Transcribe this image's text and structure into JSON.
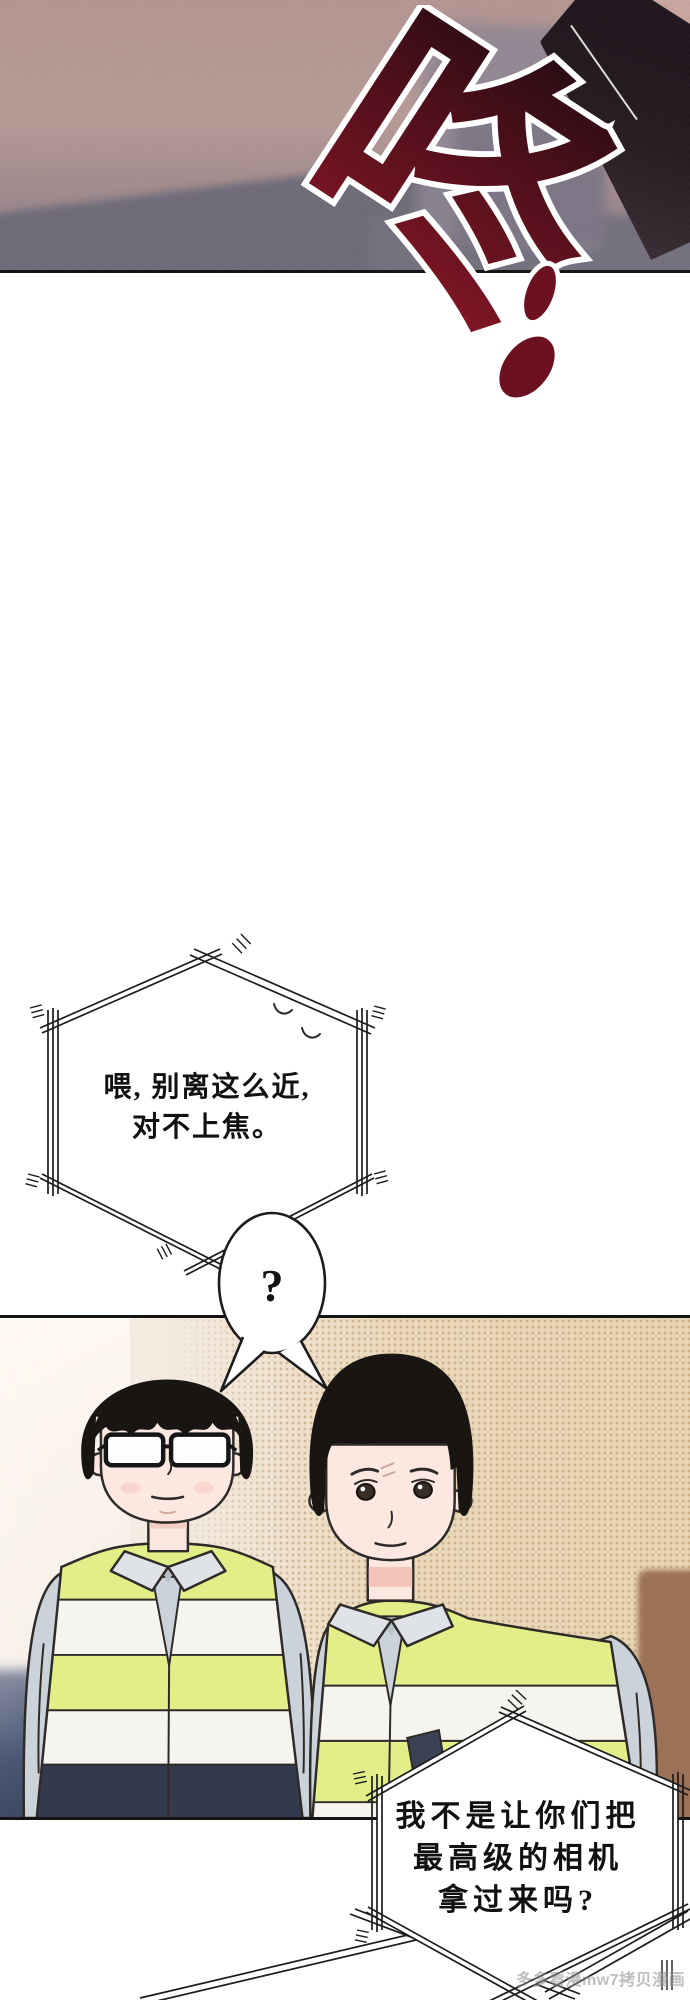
{
  "page": {
    "width": 690,
    "height": 2000
  },
  "sfx": {
    "text": "咚"
  },
  "bubbles": {
    "b1_line1": "喂, 别离这么近,",
    "b1_line2": "对不上焦。",
    "question": "?",
    "b2_line1": "我不是让你们把",
    "b2_line2": "最高级的相机",
    "b2_line3": "拿过来吗?"
  },
  "watermark": {
    "text": "多多看漫mw7拷贝漫画"
  },
  "colors": {
    "sfx_dark": "#140a10",
    "sfx_mid": "#4b0f1a",
    "sfx_red": "#8a1726",
    "outline": "#2d2a28",
    "panel1_wall": "#b39591",
    "panel1_shadow": "#6f6b79",
    "panel1_dark": "#261c22",
    "panel2_left": "#f8f1ec",
    "panel2_beige": "#e9d8ba",
    "panel2_brown": "#9b7158",
    "vest_yellow": "#e2ef89",
    "vest_white": "#f6f4ee",
    "vest_navy": "#333a4e",
    "shirt_gray": "#ccd2d9",
    "collar_gray": "#dfe3e8",
    "skin": "#fce8e1",
    "hair_black": "#181512",
    "bubble_line": "#1c1c1c",
    "watermark_gray": "#8a8a8a"
  }
}
